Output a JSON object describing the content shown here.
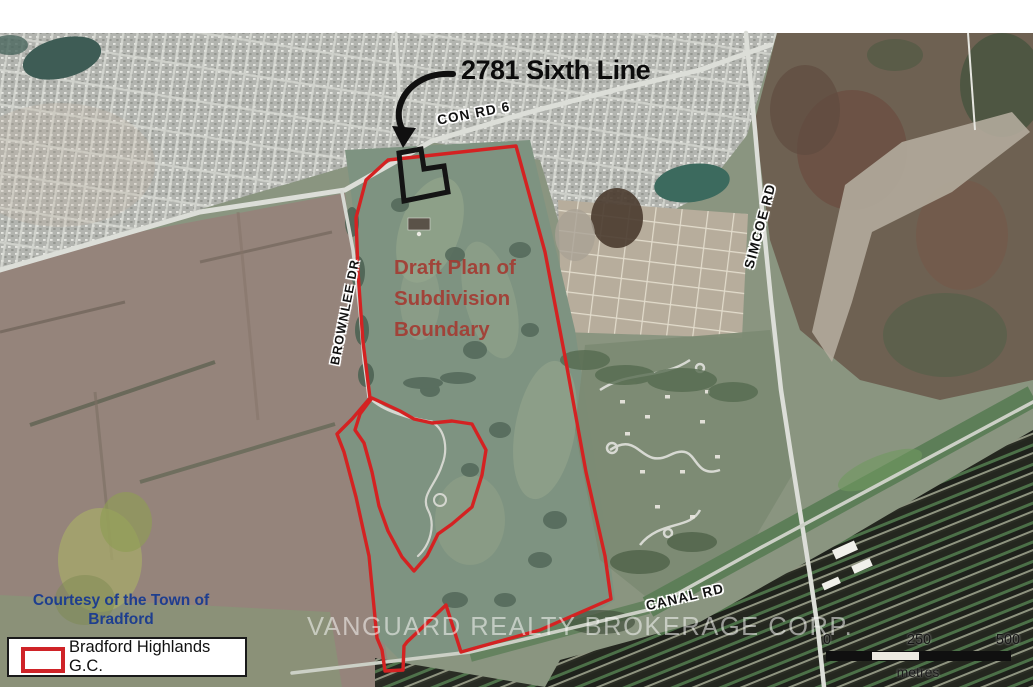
{
  "annotation": {
    "title": "2781 Sixth Line"
  },
  "road_labels": {
    "con_rd_6": "CON RD 6",
    "brownlee_dr": "BROWNLEE DR",
    "simcoe_rd": "SIMCOE RD",
    "canal_rd": "CANAL RD"
  },
  "boundary_note": "Draft Plan of\nSubdivision\nBoundary",
  "credit": "Courtesy of the Town of\nBradford",
  "watermark": "VANGUARD REALTY BROKERAGE CORP.",
  "legend": {
    "items": [
      {
        "swatch": "red-outline-rectangle",
        "label": "Bradford Highlands G.C."
      }
    ]
  },
  "scale_bar": {
    "ticks": [
      "0",
      "250",
      "500"
    ],
    "unit": "metres"
  },
  "colors": {
    "boundary_red": "#d42222",
    "parcel_black": "#141414",
    "subdivision_text_red": "#a33d34",
    "credit_blue": "#1e3e8f",
    "legend_swatch_red": "#cf2328"
  }
}
